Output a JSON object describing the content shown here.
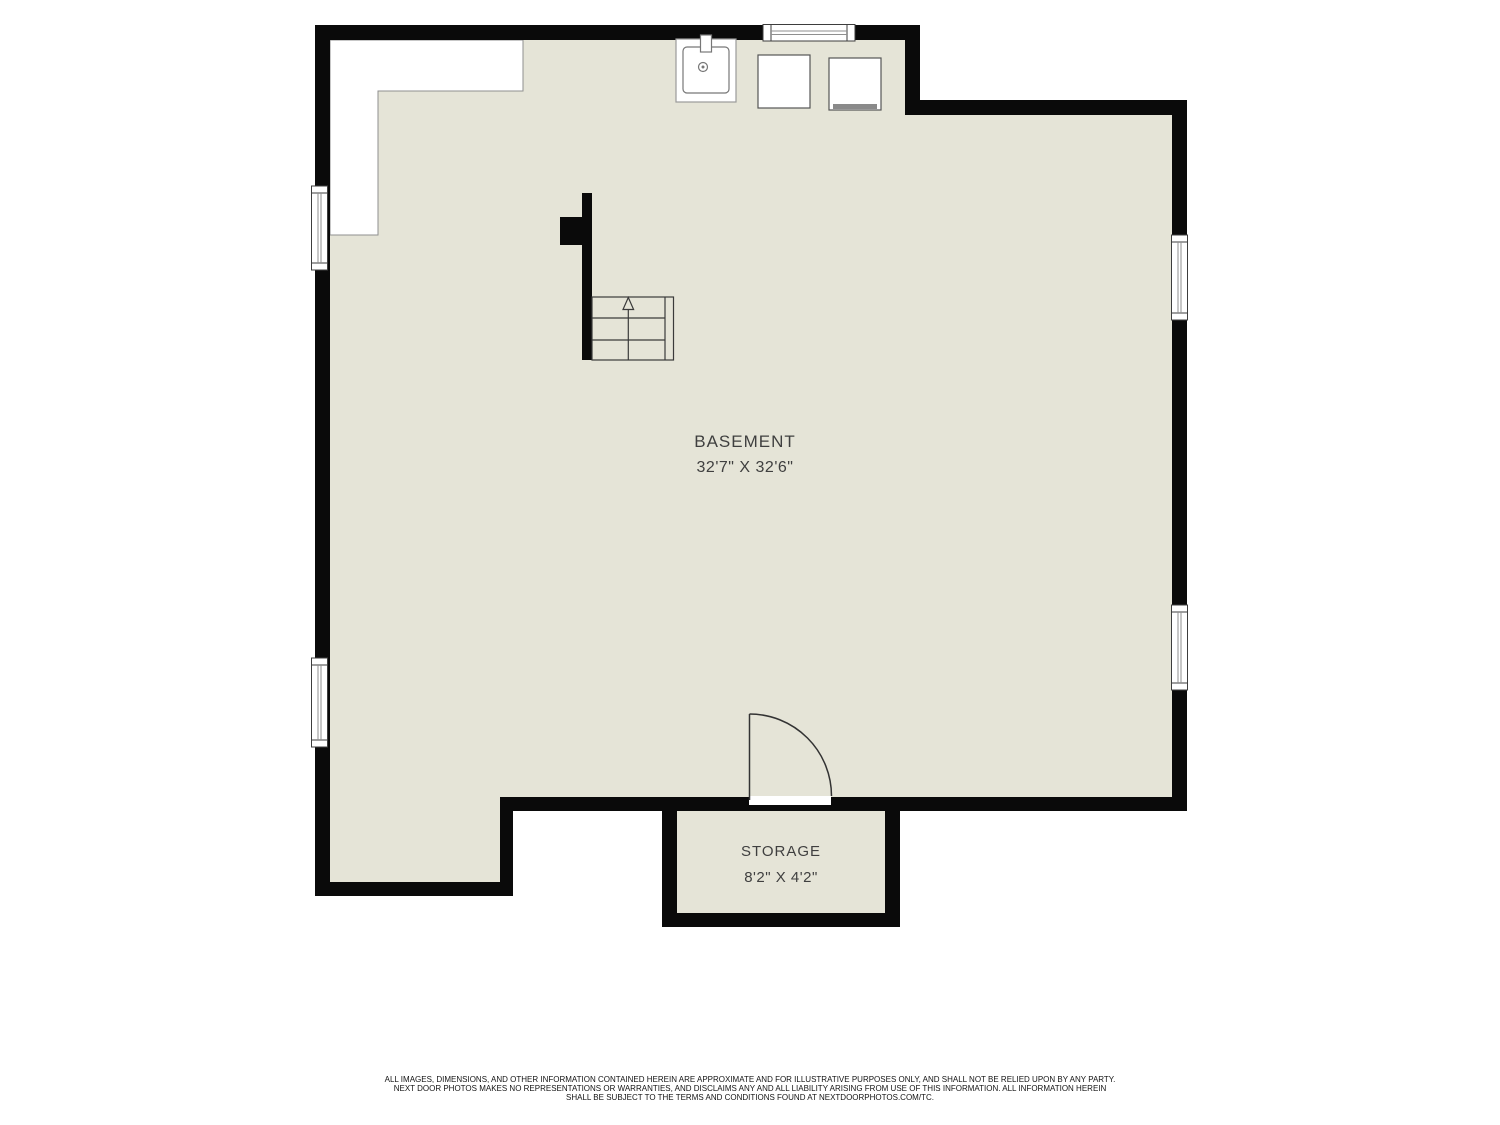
{
  "plan": {
    "basement": {
      "name": "BASEMENT",
      "dims": "32'7\" X 32'6\""
    },
    "storage": {
      "name": "STORAGE",
      "dims": "8'2\" X 4'2\""
    }
  },
  "disclaimer": {
    "line1": "ALL IMAGES, DIMENSIONS, AND OTHER INFORMATION CONTAINED HEREIN ARE APPROXIMATE AND FOR ILLUSTRATIVE PURPOSES ONLY, AND SHALL NOT BE RELIED UPON BY ANY PARTY.",
    "line2": "NEXT DOOR PHOTOS MAKES NO REPRESENTATIONS OR WARRANTIES, AND DISCLAIMS ANY AND ALL LIABILITY ARISING FROM USE OF THIS INFORMATION. ALL INFORMATION HEREIN",
    "line3": "SHALL BE SUBJECT TO THE TERMS AND CONDITIONS FOUND AT NEXTDOORPHOTOS.COM/TC."
  },
  "colors": {
    "floor": "#e5e4d7",
    "wall": "#0a0a0a",
    "label": "#3f3f3f"
  }
}
